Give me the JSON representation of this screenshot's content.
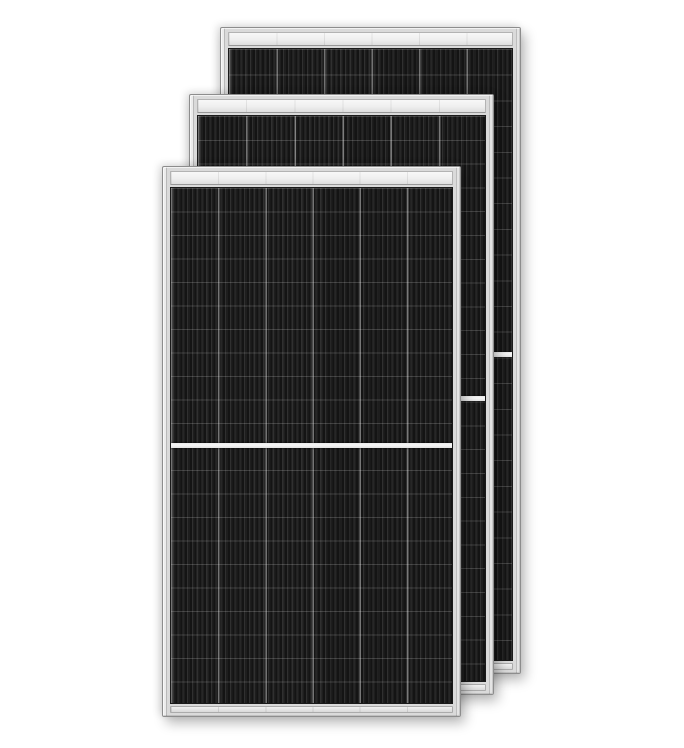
{
  "scene": {
    "description": "Three framed all-black monocrystalline half-cut solar panels overlapping in a cascade on a white background",
    "background_color": "#ffffff",
    "colors": {
      "frame_silver": "#dadada",
      "frame_edge": "#8d8d8d",
      "top_rail_light": "#f3f3f3",
      "cell_base": "#1e1e1e",
      "cell_stripe_dark": "#141414",
      "cell_stripe_light": "#303030",
      "column_divider": "rgba(255,255,255,0.40)",
      "row_line": "rgba(255,255,255,0.17)",
      "center_gap": "#f3f3f3"
    },
    "cell_texture": {
      "stripe_pitch_px": 4.75,
      "column_count": 6,
      "half_cut_center_gap": true
    },
    "panels": [
      {
        "name": "solar-panel-back",
        "z": 1,
        "left": 220,
        "top": 27,
        "width": 301,
        "height": 647,
        "columns": 6,
        "row_pitch": 25.7
      },
      {
        "name": "solar-panel-middle",
        "z": 2,
        "left": 189,
        "top": 94,
        "width": 305,
        "height": 601,
        "columns": 6,
        "row_pitch": 23.8
      },
      {
        "name": "solar-panel-front",
        "z": 3,
        "left": 162,
        "top": 166,
        "width": 299,
        "height": 551,
        "columns": 6,
        "row_pitch": 23.5
      }
    ]
  }
}
